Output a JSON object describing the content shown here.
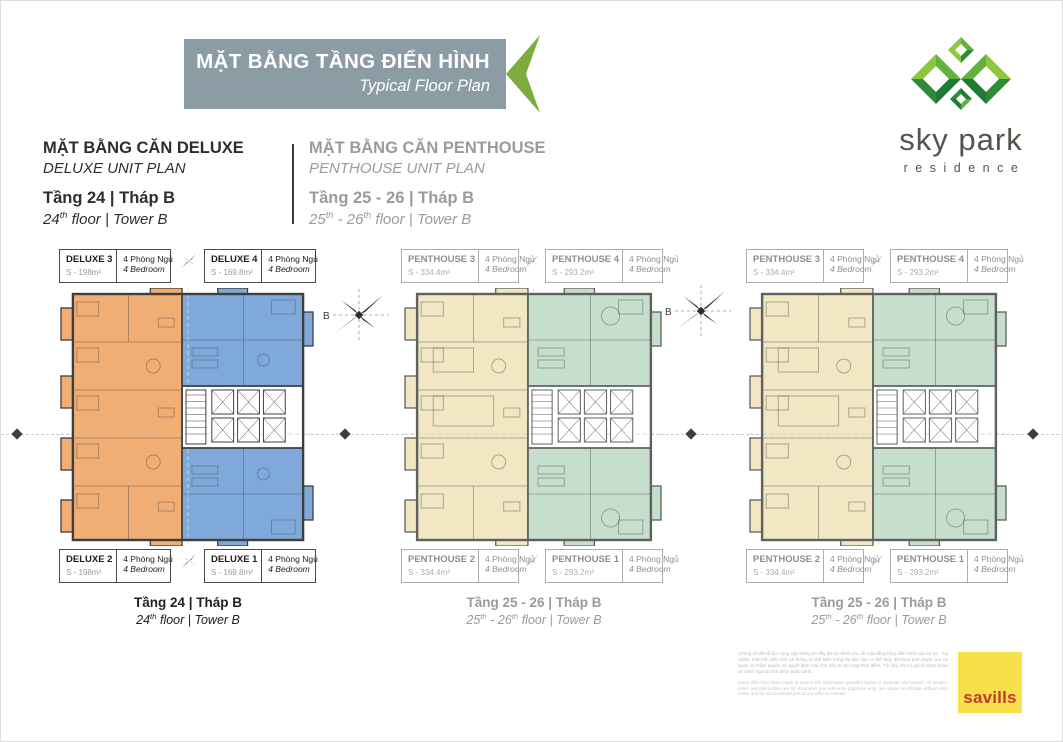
{
  "header": {
    "title_vi": "MẶT BẰNG TẦNG ĐIỂN HÌNH",
    "title_en": "Typical Floor Plan",
    "banner_color": "#8C9CA5",
    "arrow_color": "#7BAC3D"
  },
  "logo": {
    "brand": "sky park",
    "subtitle": "residence",
    "colors": {
      "light": "#8DC63F",
      "mid1": "#62B13C",
      "mid2": "#2F8A3A",
      "dark": "#1E7A36",
      "text": "#57534C"
    }
  },
  "sections": {
    "deluxe": {
      "title_vi": "MẶT BẰNG CĂN DELUXE",
      "title_en": "DELUXE UNIT PLAN",
      "floor_vi": "Tầng 24 | Tháp B",
      "floor_en_parts": [
        {
          "t": "24"
        },
        {
          "t": "th",
          "sup": true
        },
        {
          "t": " floor | Tower B"
        }
      ]
    },
    "penthouse": {
      "title_vi": "MẶT BẰNG CĂN PENTHOUSE",
      "title_en": "PENTHOUSE UNIT PLAN",
      "floor_vi": "Tầng 25 - 26 | Tháp B",
      "floor_en_parts": [
        {
          "t": "25"
        },
        {
          "t": "th",
          "sup": true
        },
        {
          "t": " - 26"
        },
        {
          "t": "th",
          "sup": true
        },
        {
          "t": " floor | Tower B"
        }
      ]
    }
  },
  "compass_label": "B",
  "plans": [
    {
      "tone": "dark",
      "colors": {
        "left": "#F1AE74",
        "right": "#7FA9DA"
      },
      "labels_top": [
        {
          "name": "DELUXE 3",
          "area": "S - 198m²",
          "rooms_vi": "4 Phòng Ngủ",
          "rooms_en": "4 Bedroom"
        },
        {
          "name": "DELUXE 4",
          "area": "S - 169.8m²",
          "rooms_vi": "4 Phòng Ngủ",
          "rooms_en": "4 Bedroom"
        }
      ],
      "labels_bottom": [
        {
          "name": "DELUXE 2",
          "area": "S - 198m²",
          "rooms_vi": "4 Phòng Ngủ",
          "rooms_en": "4 Bedroom"
        },
        {
          "name": "DELUXE 1",
          "area": "S - 169.8m²",
          "rooms_vi": "4 Phòng Ngủ",
          "rooms_en": "4 Bedroom"
        }
      ],
      "caption_vi": "Tầng 24 | Tháp B",
      "caption_en_parts": [
        {
          "t": "24"
        },
        {
          "t": "th",
          "sup": true
        },
        {
          "t": " floor | Tower B"
        }
      ]
    },
    {
      "tone": "gray",
      "colors": {
        "left": "#F1E7C2",
        "right": "#C6DECC"
      },
      "labels_top": [
        {
          "name": "PENTHOUSE 3",
          "area": "S - 334.4m²",
          "rooms_vi": "4 Phòng Ngủ",
          "rooms_en": "4 Bedroom"
        },
        {
          "name": "PENTHOUSE 4",
          "area": "S - 293.2m²",
          "rooms_vi": "4 Phòng Ngủ",
          "rooms_en": "4 Bedroom"
        }
      ],
      "labels_bottom": [
        {
          "name": "PENTHOUSE 2",
          "area": "S - 334.4m²",
          "rooms_vi": "4 Phòng Ngủ",
          "rooms_en": "4 Bedroom"
        },
        {
          "name": "PENTHOUSE 1",
          "area": "S - 293.2m²",
          "rooms_vi": "4 Phòng Ngủ",
          "rooms_en": "4 Bedroom"
        }
      ],
      "caption_vi": "Tầng 25 - 26 | Tháp B",
      "caption_en_parts": [
        {
          "t": "25"
        },
        {
          "t": "th",
          "sup": true
        },
        {
          "t": " - 26"
        },
        {
          "t": "th",
          "sup": true
        },
        {
          "t": " floor | Tower B"
        }
      ]
    },
    {
      "tone": "gray",
      "colors": {
        "left": "#F1E7C2",
        "right": "#C6DECC"
      },
      "labels_top": [
        {
          "name": "PENTHOUSE 3",
          "area": "S - 334.4m²",
          "rooms_vi": "4 Phòng Ngủ",
          "rooms_en": "4 Bedroom"
        },
        {
          "name": "PENTHOUSE 4",
          "area": "S - 293.2m²",
          "rooms_vi": "4 Phòng Ngủ",
          "rooms_en": "4 Bedroom"
        }
      ],
      "labels_bottom": [
        {
          "name": "PENTHOUSE 2",
          "area": "S - 334.4m²",
          "rooms_vi": "4 Phòng Ngủ",
          "rooms_en": "4 Bedroom"
        },
        {
          "name": "PENTHOUSE 1",
          "area": "S - 293.2m²",
          "rooms_vi": "4 Phòng Ngủ",
          "rooms_en": "4 Bedroom"
        }
      ],
      "caption_vi": "Tầng 25 - 26 | Tháp B",
      "caption_en_parts": [
        {
          "t": "25"
        },
        {
          "t": "th",
          "sup": true
        },
        {
          "t": " - 26"
        },
        {
          "t": "th",
          "sup": true
        },
        {
          "t": " floor | Tower B"
        }
      ]
    }
  ],
  "footer": {
    "disclaimer_vi": "Chúng tôi đã nỗ lực cung cấp thông tin đầy đủ và chính xác về mặt bằng tầng điển hình của dự án. Tuy nhiên, thiết kế, diện tích và thông tin thể hiện trong tài liệu này có thể thay đổi theo phê duyệt của cơ quan có thẩm quyền và quyết định của chủ đầu tư tại từng thời điểm. Tài liệu chỉ có giá trị tham khảo và minh họa tại thời điểm phát hành.",
    "disclaimer_en": "Every effort has been made to ensure the information provided herein is accurate and correct. All images, plans and information are for illustrative and reference purposes only, are subject to change without prior notice and do not constitute part of any offer or contract.",
    "savills_label": "savills",
    "savills_bg": "#F7E04A",
    "savills_color": "#C23B2A"
  }
}
